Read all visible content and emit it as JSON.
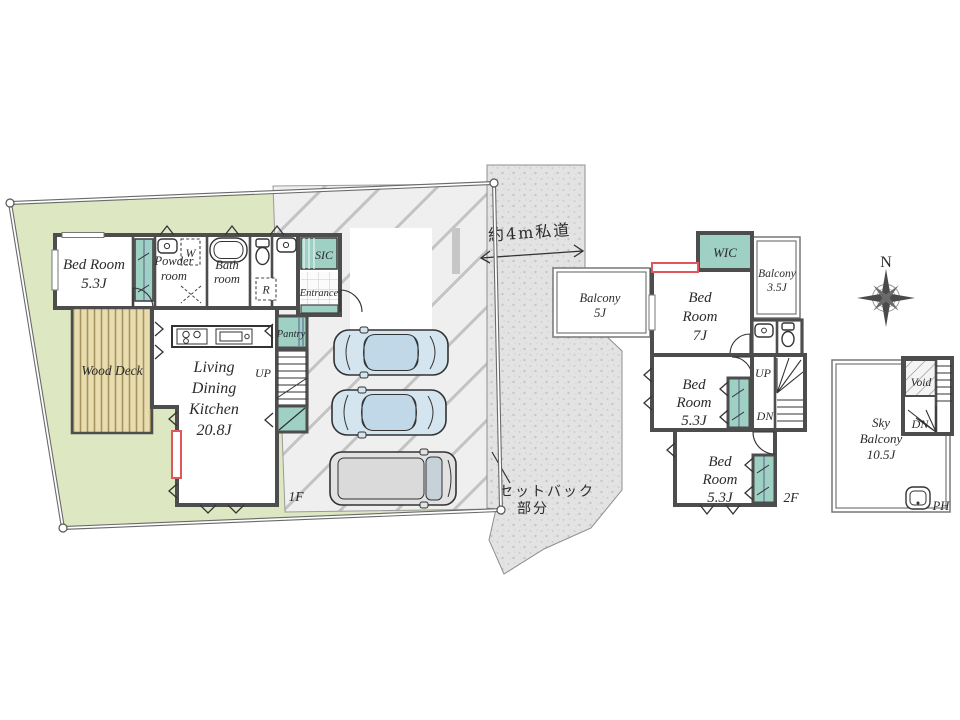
{
  "plan1f": {
    "bedroom": {
      "l1": "Bed Room",
      "l2": "5.3J"
    },
    "powder": {
      "l1": "Powder",
      "l2": "room"
    },
    "washer": "W",
    "bath": {
      "l1": "Bath",
      "l2": "room"
    },
    "toilet": "",
    "sic": "SIC",
    "entrance": "Entrance",
    "fridge": "R",
    "pantry": "Pantry",
    "up": "UP",
    "ldk": {
      "l1": "Living",
      "l2": "Dining",
      "l3": "Kitchen",
      "l4": "20.8J"
    },
    "wood_deck": "Wood Deck",
    "floor_label": "1F"
  },
  "site": {
    "road_label": "約4m私道",
    "setback_l1": "セットバック",
    "setback_l2": "部分"
  },
  "plan2f": {
    "balcony5": {
      "l1": "Balcony",
      "l2": "5J"
    },
    "wic": "WIC",
    "balcony35": {
      "l1": "Balcony",
      "l2": "3.5J"
    },
    "bedroom7": {
      "l1": "Bed",
      "l2": "Room",
      "l3": "7J"
    },
    "bedroom53a": {
      "l1": "Bed",
      "l2": "Room",
      "l3": "5.3J"
    },
    "bedroom53b": {
      "l1": "Bed",
      "l2": "Room",
      "l3": "5.3J"
    },
    "up": "UP",
    "dn": "DN",
    "floor_label": "2F"
  },
  "planph": {
    "sky_balcony": {
      "l1": "Sky",
      "l2": "Balcony",
      "l3": "10.5J"
    },
    "void": "Void",
    "dn": "DN",
    "floor_label": "PH"
  },
  "compass": {
    "north": "N"
  },
  "colors": {
    "site_green": "#dde7c2",
    "teal": "#9ed0c4",
    "deck": "#e9ddb0",
    "window_red": "#e0565a"
  }
}
